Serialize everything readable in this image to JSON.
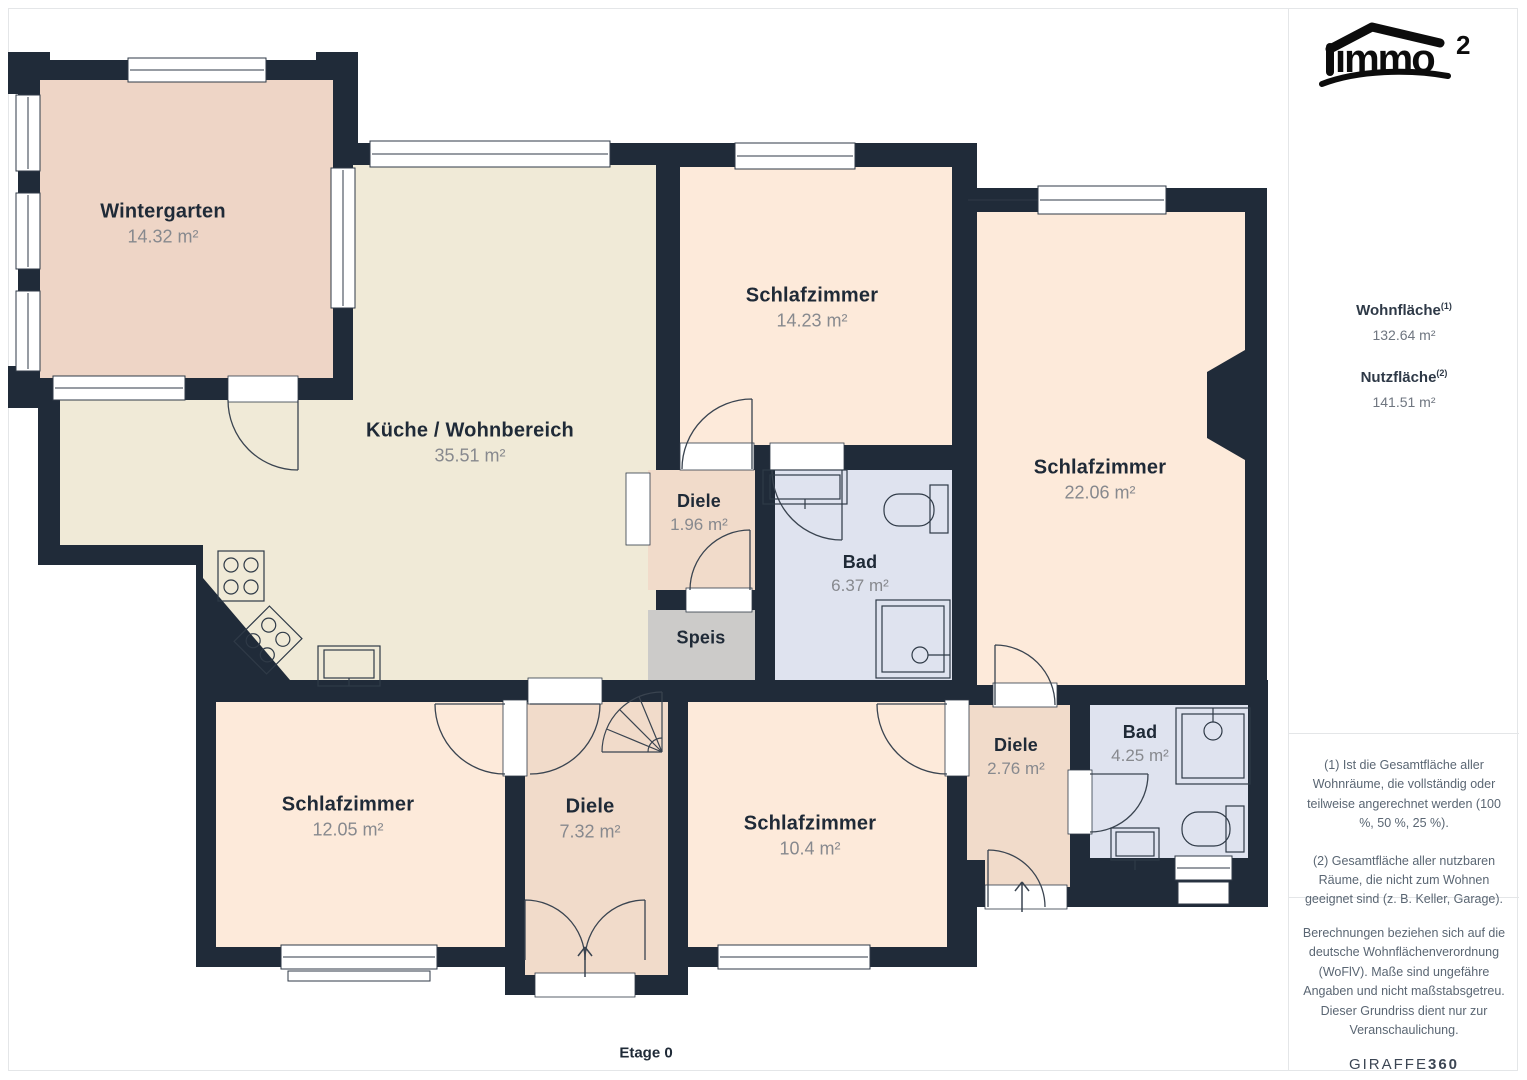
{
  "branding": {
    "logo_text": "immo",
    "logo_sup": "2"
  },
  "rooms": [
    {
      "name": "Wintergarten",
      "area": "14.32 m²"
    },
    {
      "name": "Küche / Wohnbereich",
      "area": "35.51 m²"
    },
    {
      "name": "Schlafzimmer",
      "area": "14.23 m²"
    },
    {
      "name": "Schlafzimmer",
      "area": "22.06 m²"
    },
    {
      "name": "Diele",
      "area": "1.96 m²"
    },
    {
      "name": "Bad",
      "area": "6.37 m²"
    },
    {
      "name": "Speis",
      "area": ""
    },
    {
      "name": "Schlafzimmer",
      "area": "12.05 m²"
    },
    {
      "name": "Diele",
      "area": "7.32 m²"
    },
    {
      "name": "Schlafzimmer",
      "area": "10.4 m²"
    },
    {
      "name": "Diele",
      "area": "2.76 m²"
    },
    {
      "name": "Bad",
      "area": "4.25 m²"
    }
  ],
  "floor_label": "Etage 0",
  "sidebar": {
    "living_area_label": "Wohnfläche",
    "living_area_sup": "(1)",
    "living_area_value": "132.64 m²",
    "usable_area_label": "Nutzfläche",
    "usable_area_sup": "(2)",
    "usable_area_value": "141.51 m²",
    "footnote_1": "(1) Ist die Gesamtfläche aller Wohnräume, die vollständig oder teilweise angerechnet werden (100 %, 50 %, 25 %).",
    "footnote_2": "(2) Gesamtfläche aller nutzbaren Räume, die nicht zum Wohnen geeignet sind (z. B. Keller, Garage).",
    "disclaimer": "Berechnungen beziehen sich auf die deutsche Wohnflächenverordnung (WoFlV). Maße sind ungefähre Angaben und nicht maßstabsgetreu. Dieser Grundriss dient nur zur Veranschaulichung.",
    "brand_name": "GIRAFFE",
    "brand_suffix": "360"
  },
  "colors": {
    "wall": "#202b39",
    "room_peach": "#fdeada",
    "room_cream": "#f0ead7",
    "room_salmon": "#eed5c6",
    "room_salmon2": "#f1dbca",
    "room_blue": "#dfe3ef",
    "room_gray": "#cccbc9"
  }
}
